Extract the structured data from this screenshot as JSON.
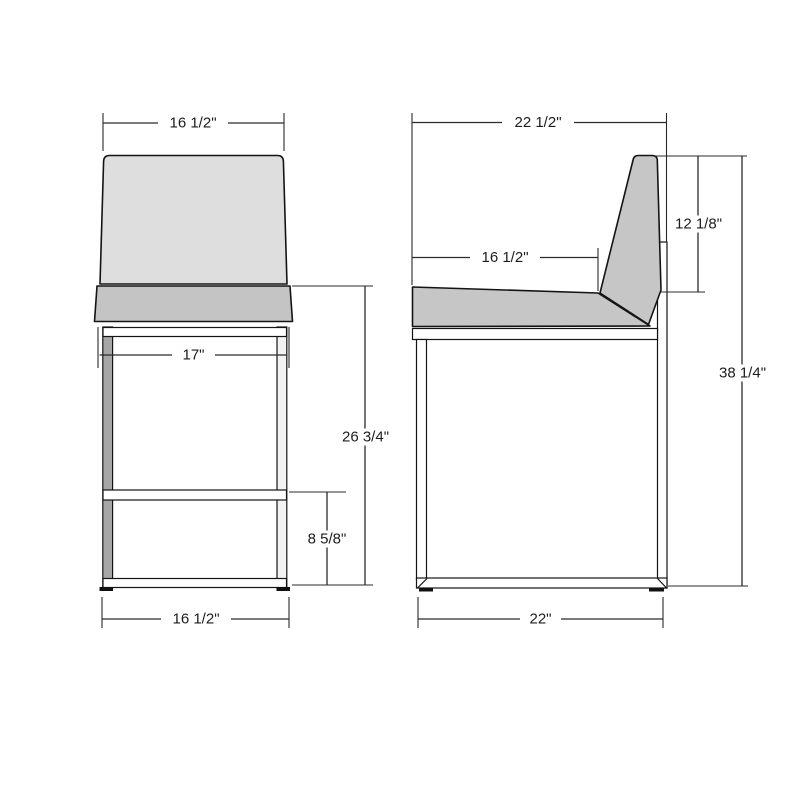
{
  "drawing": {
    "type": "furniture technical drawing",
    "subject": "counter stool, front and side orthographic views",
    "front_view": {
      "dims": {
        "top_width": "16 1/2\"",
        "leg_span": "17\"",
        "seat_height": "26 3/4\"",
        "footrest_height": "8 5/8\"",
        "base_width": "16 1/2\""
      }
    },
    "side_view": {
      "dims": {
        "overall_depth": "22 1/2\"",
        "seat_depth": "16 1/2\"",
        "backrest_height": "12 1/8\"",
        "overall_height": "38 1/4\"",
        "base_depth": "22\""
      }
    },
    "colors": {
      "backrest_front": "#dedede",
      "seat_front": "#c4c4c4",
      "side_upholstery": "#c6c6c6",
      "leg_gray": "#a6a6a6",
      "leg_light": "#f2f2f2",
      "frame_white": "#ffffff",
      "line": "#141414",
      "background": "#ffffff"
    }
  }
}
